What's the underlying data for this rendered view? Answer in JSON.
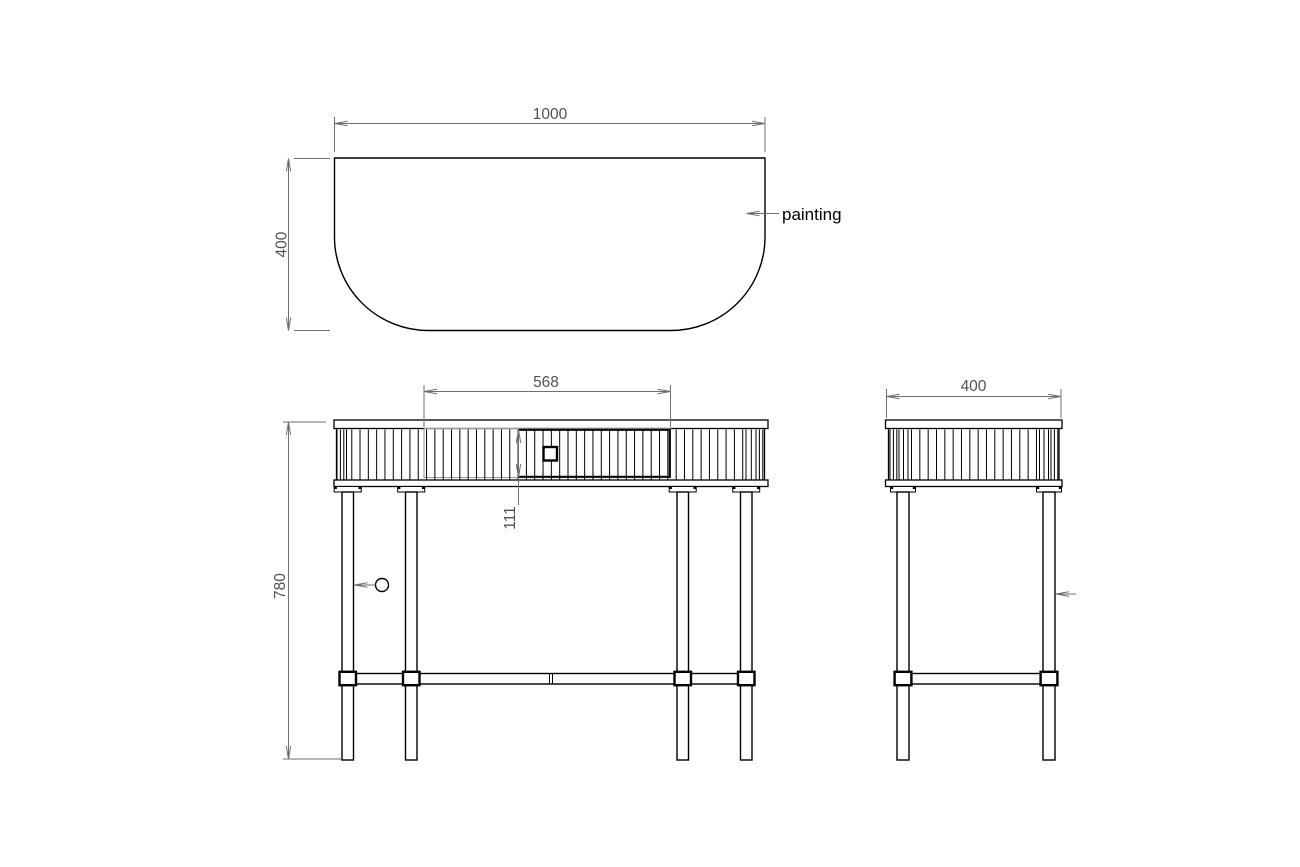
{
  "meta": {
    "background_color": "#ffffff",
    "object_line_color": "#000000",
    "dimension_line_color": "#6f6f6f",
    "dimension_text_color": "#525252",
    "drawer_opening_line_color": "#9a9a9a"
  },
  "plan_view": {
    "name": "tabletop plan view",
    "width_dim": "1000",
    "depth_dim": "400",
    "label": "painting"
  },
  "front_view": {
    "name": "front elevation",
    "drawer_width_dim": "568",
    "drawer_height_dim": "111",
    "height_dim": "780"
  },
  "side_view": {
    "name": "side elevation",
    "depth_dim": "400"
  }
}
